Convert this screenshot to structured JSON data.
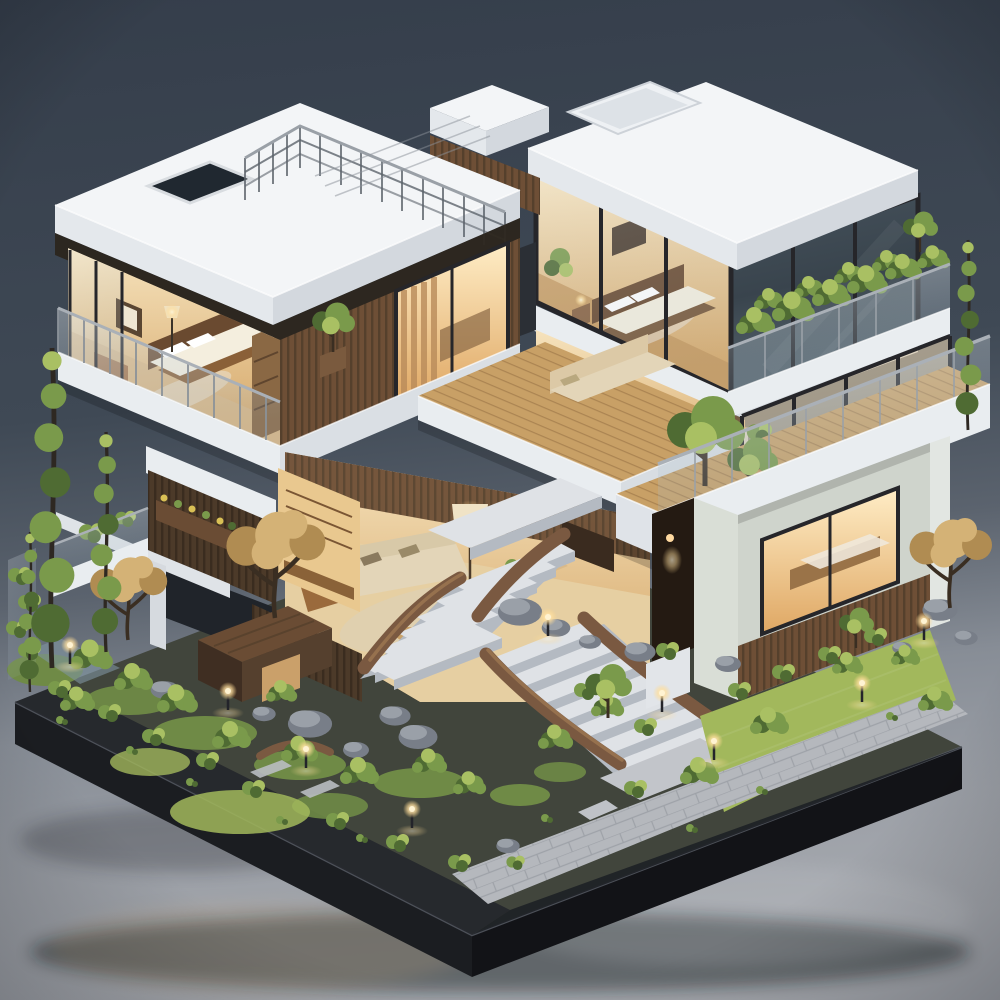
{
  "scene": {
    "subject": "Isometric 3D architectural model of a modern three-story house",
    "description": "Miniature 3D render of a modern multi-level house with cutaway interiors: white flat roofs with a metal-railed rooftop terrace and skylights, a glass-walled corner bedroom, an open master bedroom, warm-lit living rooms with sofas and a drum floor lamp, wood-slat walls, glass-balustrade balconies with rooftop gardens, a grand curved wooden staircase descending into a landscaped zen garden with boulders, moss, bright lawns, stone paver paths, glowing path lamps, tall columnar cypress trees, autumn-toned trees and a small wooden shed, all sitting on a dark charcoal display base against a studio gray-blue gradient backdrop.",
    "style": "photorealistic miniature / diorama render",
    "camera": "high three-quarter isometric view",
    "time_of_day": "dusk with warm interior lighting"
  },
  "palette": {
    "background_top": "#353e4b",
    "background_bottom": "#a7aab0",
    "base_top": "#3f4339",
    "base_side_front": "#1b1d21",
    "base_side_right": "#121317",
    "roof_top": "#f3f5f7",
    "roof_side_light": "#e4e8ec",
    "roof_side_dark": "#d3d8de",
    "slab": "#e9edf0",
    "wood": "#6e4f36",
    "wood_dark": "#4a3526",
    "wood_light": "#a97c50",
    "deck": "#c8a066",
    "glass": "#b9cdd8",
    "glass_dark": "#3c4750",
    "frame": "#26262a",
    "metal": "#5d646c",
    "interior_warm": "#f2d9a8",
    "interior_deep": "#cf9a5c",
    "lamp_glow": "#ffe9b8",
    "cream": "#efe6d2",
    "sofa": "#e3d5b8",
    "green_light": "#a9c063",
    "green_mid": "#7a9a4b",
    "green_dark": "#4f6b33",
    "lawn": "#a2b85c",
    "moss": "#6f8a46",
    "soil": "#41453c",
    "autumn_light": "#d4b276",
    "autumn_dark": "#b08c52",
    "trunk": "#3a2e22",
    "rock_light": "#9aa0a8",
    "rock_dark": "#787e88",
    "stone_tread": "#dfe2e6",
    "stone_riser": "#b4bac2",
    "stair_wood": "#7a5941",
    "path": "#b5b8bd"
  },
  "elements": [
    {
      "name": "display-base",
      "description": "dark charcoal rectangular plinth with beveled rim"
    },
    {
      "name": "rooftop-terrace",
      "description": "white flat roof with thin metal guard railing and skylight"
    },
    {
      "name": "glass-bedroom-suite",
      "description": "upper corner room with floor-to-ceiling glazing and bed"
    },
    {
      "name": "master-bedroom",
      "description": "open cutaway bedroom with bed, dresser and wardrobe"
    },
    {
      "name": "upper-balcony",
      "description": "glass-balustrade balcony with potted tree"
    },
    {
      "name": "green-balcony",
      "description": "planted roof garden balcony with glass rail"
    },
    {
      "name": "terrace-deck",
      "description": "large wood deck terrace with trees and glass railing"
    },
    {
      "name": "living-room",
      "description": "warm-lit lounge with cream sofa, drum floor lamp, coffee table"
    },
    {
      "name": "mid-lounge",
      "description": "second-floor sitting area on wood deck"
    },
    {
      "name": "bar-nook",
      "description": "small wood shelving bar interior"
    },
    {
      "name": "ground-floor-room",
      "description": "glazed room with warm interior light and wood-slat base"
    },
    {
      "name": "grand-staircase",
      "description": "curved wood-stringer stone staircase in two flights"
    },
    {
      "name": "zen-garden",
      "description": "moss mounds, boulders, bushes and stone paver path"
    },
    {
      "name": "cypress-trees",
      "description": "tall columnar pom-pom cypress trees"
    },
    {
      "name": "autumn-trees",
      "description": "tan-orange foliage trees"
    },
    {
      "name": "path-lamps",
      "description": "small glowing garden bollard lights"
    },
    {
      "name": "garden-shed",
      "description": "small dark-wood pavilion"
    },
    {
      "name": "lawn",
      "description": "bright yellow-green grass patches"
    },
    {
      "name": "backdrop",
      "description": "seamless studio gradient, dark slate above, light gray floor below"
    }
  ]
}
